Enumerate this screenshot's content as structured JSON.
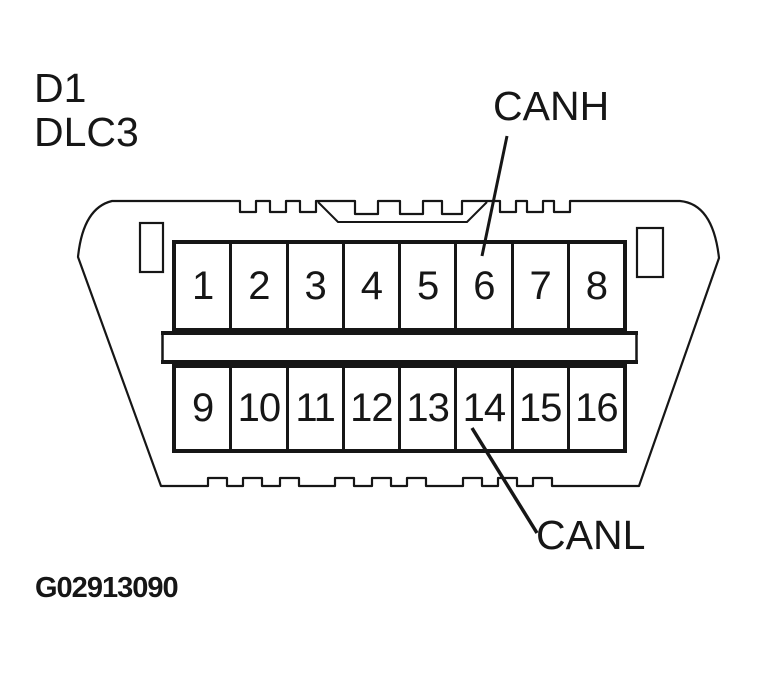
{
  "title": {
    "line1": "D1",
    "line2": "DLC3"
  },
  "figure_code": "G02913090",
  "connector": {
    "pins_top": [
      "1",
      "2",
      "3",
      "4",
      "5",
      "6",
      "7",
      "8"
    ],
    "pins_bottom": [
      "9",
      "10",
      "11",
      "12",
      "13",
      "14",
      "15",
      "16"
    ],
    "callouts": [
      {
        "label": "CANH",
        "points_to_pin": "6"
      },
      {
        "label": "CANL",
        "points_to_pin": "14"
      }
    ]
  },
  "colors": {
    "ink": "#161616",
    "background": "#ffffff"
  }
}
